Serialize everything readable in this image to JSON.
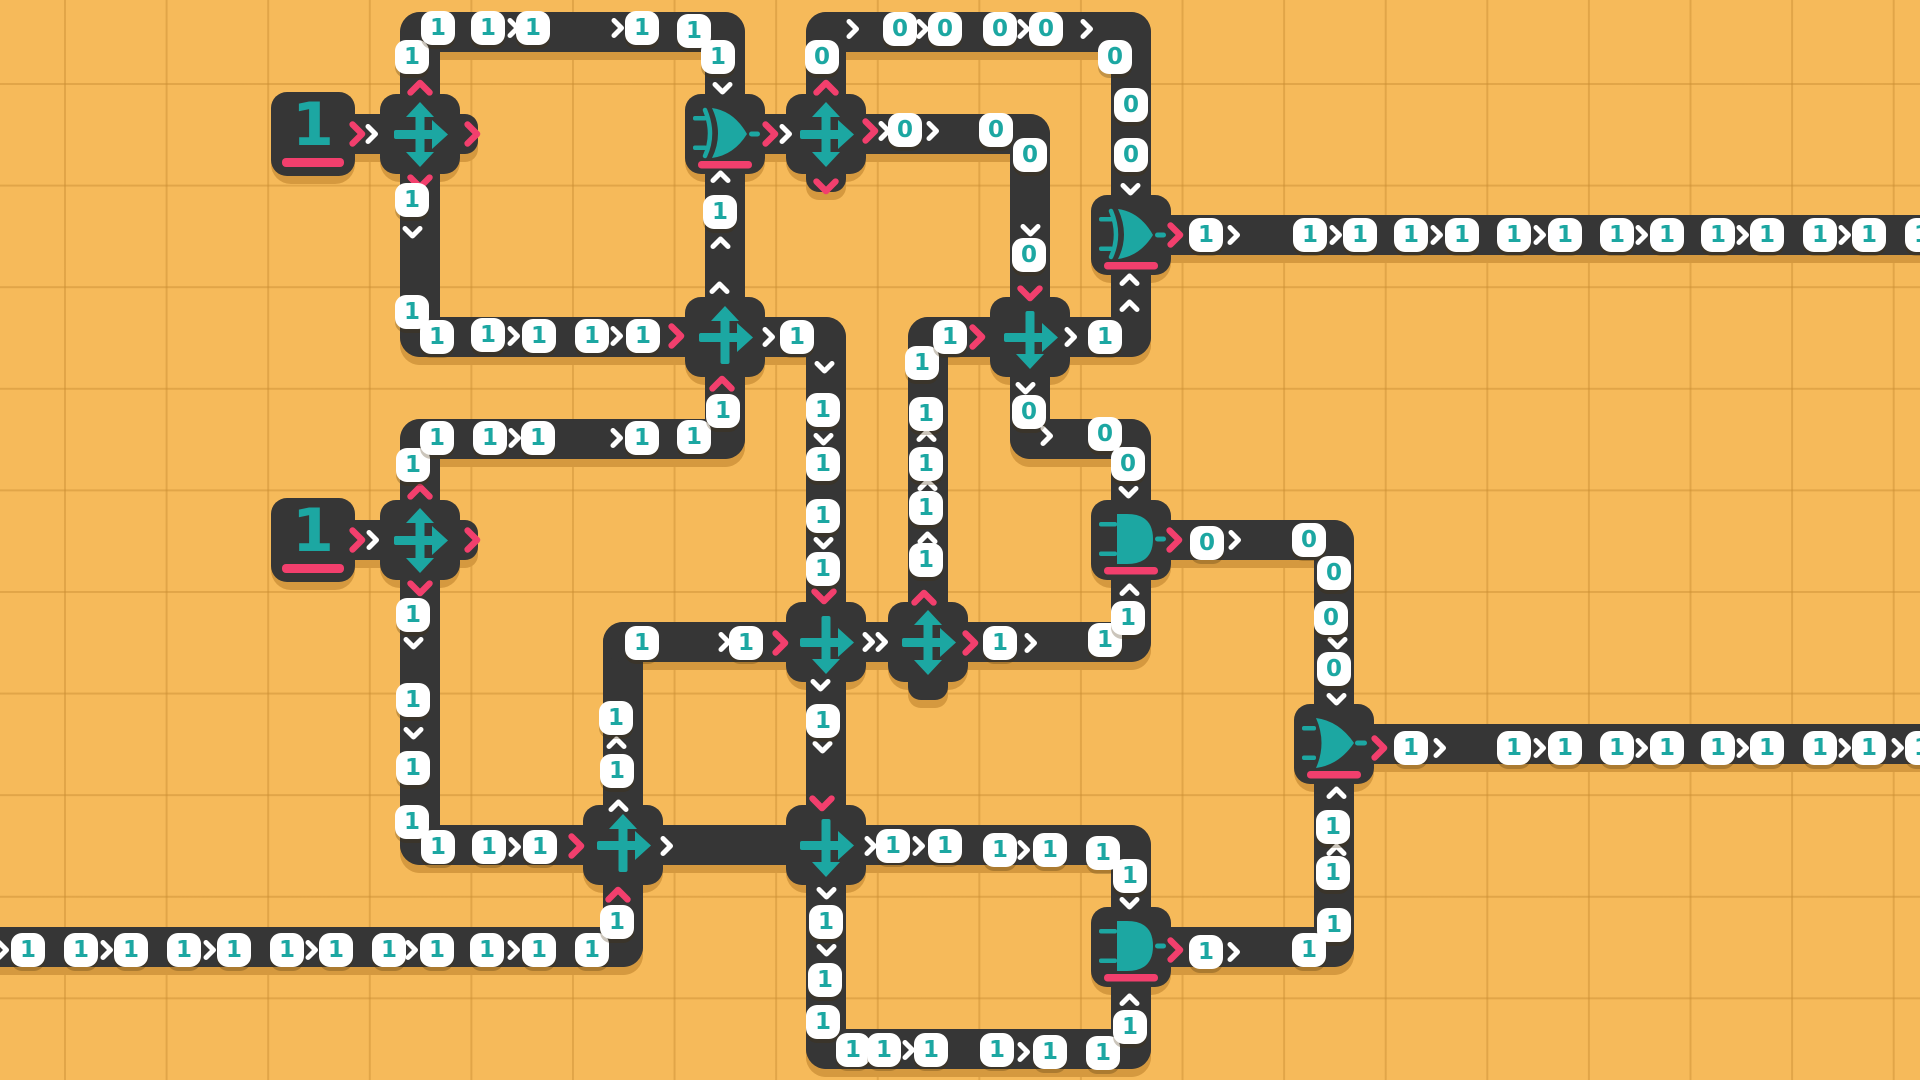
{
  "board": {
    "width": 1920,
    "height": 1080,
    "grid_pitch": 101.6,
    "grid_offset_x": 64,
    "grid_offset_y": 83
  },
  "colors": {
    "background": "#F6BA5A",
    "grid_line": "#DFA449",
    "wire": "#363636",
    "shadow": "#D5993F",
    "teal": "#1CA7A2",
    "pink": "#F23F6D",
    "pill": "#FFFFFF"
  },
  "legend": {
    "pill_values": [
      "0",
      "1"
    ],
    "tile_types": [
      "source",
      "splitter",
      "cross_ur",
      "cross_dr",
      "xor",
      "and",
      "or"
    ]
  },
  "tiles": [
    {
      "type": "source",
      "x": 313,
      "y": 134,
      "label": "1"
    },
    {
      "type": "splitter",
      "x": 420,
      "y": 134
    },
    {
      "type": "xor",
      "x": 725,
      "y": 134
    },
    {
      "type": "splitter",
      "x": 826,
      "y": 134
    },
    {
      "type": "xor",
      "x": 1131,
      "y": 235
    },
    {
      "type": "cross_ur",
      "x": 725,
      "y": 337
    },
    {
      "type": "cross_dr",
      "x": 1030,
      "y": 337
    },
    {
      "type": "source",
      "x": 313,
      "y": 540,
      "label": "1"
    },
    {
      "type": "splitter",
      "x": 420,
      "y": 540
    },
    {
      "type": "and",
      "x": 1131,
      "y": 540
    },
    {
      "type": "cross_dr",
      "x": 826,
      "y": 642
    },
    {
      "type": "splitter",
      "x": 928,
      "y": 642
    },
    {
      "type": "or",
      "x": 1334,
      "y": 744
    },
    {
      "type": "cross_ur",
      "x": 623,
      "y": 845
    },
    {
      "type": "cross_dr",
      "x": 826,
      "y": 845
    },
    {
      "type": "and",
      "x": 1131,
      "y": 947
    }
  ],
  "nubs": [
    {
      "x": 420,
      "y": 134,
      "dir": "r"
    },
    {
      "x": 826,
      "y": 134,
      "dir": "d"
    },
    {
      "x": 420,
      "y": 540,
      "dir": "r"
    },
    {
      "x": 928,
      "y": 642,
      "dir": "d"
    }
  ],
  "wires": [
    [
      330,
      134,
      392,
      134
    ],
    [
      420,
      134,
      420,
      32
    ],
    [
      420,
      32,
      725,
      32
    ],
    [
      725,
      32,
      725,
      134
    ],
    [
      420,
      134,
      420,
      337
    ],
    [
      420,
      337,
      725,
      337
    ],
    [
      725,
      337,
      725,
      134
    ],
    [
      758,
      134,
      795,
      134
    ],
    [
      826,
      134,
      826,
      32
    ],
    [
      826,
      32,
      1131,
      32
    ],
    [
      1131,
      32,
      1131,
      235
    ],
    [
      862,
      134,
      1030,
      134
    ],
    [
      1030,
      134,
      1030,
      337
    ],
    [
      1030,
      337,
      1030,
      439
    ],
    [
      1030,
      439,
      1131,
      439
    ],
    [
      1131,
      439,
      1131,
      540
    ],
    [
      1066,
      337,
      1131,
      337
    ],
    [
      1131,
      337,
      1131,
      235
    ],
    [
      1167,
      235,
      1940,
      235
    ],
    [
      761,
      337,
      826,
      337
    ],
    [
      826,
      337,
      826,
      642
    ],
    [
      928,
      642,
      928,
      337
    ],
    [
      928,
      337,
      994,
      337
    ],
    [
      330,
      540,
      392,
      540
    ],
    [
      420,
      540,
      420,
      439
    ],
    [
      420,
      439,
      725,
      439
    ],
    [
      725,
      439,
      725,
      337
    ],
    [
      420,
      540,
      420,
      845
    ],
    [
      420,
      845,
      623,
      845
    ],
    [
      623,
      845,
      623,
      642
    ],
    [
      623,
      642,
      826,
      642
    ],
    [
      862,
      642,
      928,
      642
    ],
    [
      964,
      642,
      1131,
      642
    ],
    [
      1131,
      642,
      1131,
      540
    ],
    [
      1167,
      540,
      1334,
      540
    ],
    [
      1334,
      540,
      1334,
      744
    ],
    [
      1334,
      744,
      1334,
      947
    ],
    [
      1334,
      947,
      1167,
      947
    ],
    [
      1370,
      744,
      1940,
      744
    ],
    [
      826,
      642,
      826,
      845
    ],
    [
      659,
      845,
      826,
      845
    ],
    [
      862,
      845,
      1131,
      845
    ],
    [
      1131,
      845,
      1131,
      947
    ],
    [
      826,
      845,
      826,
      1049
    ],
    [
      826,
      1049,
      1131,
      1049
    ],
    [
      1131,
      1049,
      1131,
      947
    ],
    [
      -30,
      947,
      623,
      947
    ],
    [
      623,
      947,
      623,
      845
    ]
  ],
  "pills": [
    [
      412,
      57,
      "1"
    ],
    [
      438,
      28,
      "1"
    ],
    [
      488,
      28,
      "1"
    ],
    [
      533,
      28,
      "1"
    ],
    [
      642,
      28,
      "1"
    ],
    [
      694,
      31,
      "1"
    ],
    [
      718,
      57,
      "1"
    ],
    [
      720,
      212,
      "1"
    ],
    [
      412,
      200,
      "1"
    ],
    [
      412,
      312,
      "1"
    ],
    [
      437,
      337,
      "1"
    ],
    [
      488,
      335,
      "1"
    ],
    [
      539,
      336,
      "1"
    ],
    [
      592,
      336,
      "1"
    ],
    [
      643,
      336,
      "1"
    ],
    [
      822,
      57,
      "0"
    ],
    [
      900,
      29,
      "0"
    ],
    [
      945,
      29,
      "0"
    ],
    [
      1000,
      29,
      "0"
    ],
    [
      1046,
      29,
      "0"
    ],
    [
      1115,
      57,
      "0"
    ],
    [
      1131,
      105,
      "0"
    ],
    [
      1131,
      155,
      "0"
    ],
    [
      905,
      130,
      "0"
    ],
    [
      996,
      130,
      "0"
    ],
    [
      1030,
      155,
      "0"
    ],
    [
      1029,
      255,
      "0"
    ],
    [
      1029,
      412,
      "0"
    ],
    [
      1105,
      434,
      "0"
    ],
    [
      1128,
      464,
      "0"
    ],
    [
      1105,
      337,
      "1"
    ],
    [
      1206,
      235,
      "1"
    ],
    [
      1310,
      235,
      "1"
    ],
    [
      1360,
      235,
      "1"
    ],
    [
      1411,
      235,
      "1"
    ],
    [
      1462,
      235,
      "1"
    ],
    [
      1514,
      235,
      "1"
    ],
    [
      1565,
      235,
      "1"
    ],
    [
      1617,
      235,
      "1"
    ],
    [
      1667,
      235,
      "1"
    ],
    [
      1718,
      235,
      "1"
    ],
    [
      1767,
      235,
      "1"
    ],
    [
      1820,
      235,
      "1"
    ],
    [
      1869,
      235,
      "1"
    ],
    [
      1922,
      235,
      "1"
    ],
    [
      413,
      465,
      "1"
    ],
    [
      437,
      438,
      "1"
    ],
    [
      490,
      438,
      "1"
    ],
    [
      538,
      438,
      "1"
    ],
    [
      642,
      438,
      "1"
    ],
    [
      694,
      437,
      "1"
    ],
    [
      723,
      411,
      "1"
    ],
    [
      797,
      337,
      "1"
    ],
    [
      823,
      410,
      "1"
    ],
    [
      823,
      464,
      "1"
    ],
    [
      823,
      516,
      "1"
    ],
    [
      823,
      569,
      "1"
    ],
    [
      926,
      560,
      "1"
    ],
    [
      926,
      508,
      "1"
    ],
    [
      926,
      464,
      "1"
    ],
    [
      926,
      414,
      "1"
    ],
    [
      922,
      363,
      "1"
    ],
    [
      950,
      337,
      "1"
    ],
    [
      413,
      615,
      "1"
    ],
    [
      413,
      700,
      "1"
    ],
    [
      413,
      768,
      "1"
    ],
    [
      412,
      822,
      "1"
    ],
    [
      438,
      847,
      "1"
    ],
    [
      489,
      847,
      "1"
    ],
    [
      540,
      847,
      "1"
    ],
    [
      617,
      771,
      "1"
    ],
    [
      616,
      718,
      "1"
    ],
    [
      642,
      643,
      "1"
    ],
    [
      746,
      643,
      "1"
    ],
    [
      823,
      721,
      "1"
    ],
    [
      1000,
      643,
      "1"
    ],
    [
      1105,
      640,
      "1"
    ],
    [
      1128,
      618,
      "1"
    ],
    [
      1207,
      543,
      "0"
    ],
    [
      1309,
      540,
      "0"
    ],
    [
      1334,
      573,
      "0"
    ],
    [
      1331,
      618,
      "0"
    ],
    [
      1334,
      669,
      "0"
    ],
    [
      1333,
      827,
      "1"
    ],
    [
      1333,
      873,
      "1"
    ],
    [
      1334,
      925,
      "1"
    ],
    [
      1309,
      950,
      "1"
    ],
    [
      1411,
      748,
      "1"
    ],
    [
      1514,
      748,
      "1"
    ],
    [
      1565,
      748,
      "1"
    ],
    [
      1617,
      748,
      "1"
    ],
    [
      1667,
      748,
      "1"
    ],
    [
      1718,
      748,
      "1"
    ],
    [
      1767,
      748,
      "1"
    ],
    [
      1820,
      748,
      "1"
    ],
    [
      1869,
      748,
      "1"
    ],
    [
      1922,
      748,
      "1"
    ],
    [
      1206,
      952,
      "1"
    ],
    [
      893,
      846,
      "1"
    ],
    [
      945,
      846,
      "1"
    ],
    [
      1000,
      850,
      "1"
    ],
    [
      1050,
      850,
      "1"
    ],
    [
      1103,
      853,
      "1"
    ],
    [
      1130,
      876,
      "1"
    ],
    [
      826,
      922,
      "1"
    ],
    [
      825,
      980,
      "1"
    ],
    [
      823,
      1022,
      "1"
    ],
    [
      853,
      1050,
      "1"
    ],
    [
      884,
      1050,
      "1"
    ],
    [
      931,
      1050,
      "1"
    ],
    [
      997,
      1050,
      "1"
    ],
    [
      1050,
      1052,
      "1"
    ],
    [
      1103,
      1053,
      "1"
    ],
    [
      1130,
      1027,
      "1"
    ],
    [
      28,
      950,
      "1"
    ],
    [
      81,
      950,
      "1"
    ],
    [
      131,
      950,
      "1"
    ],
    [
      184,
      950,
      "1"
    ],
    [
      234,
      950,
      "1"
    ],
    [
      287,
      950,
      "1"
    ],
    [
      336,
      950,
      "1"
    ],
    [
      389,
      950,
      "1"
    ],
    [
      437,
      950,
      "1"
    ],
    [
      487,
      950,
      "1"
    ],
    [
      539,
      950,
      "1"
    ],
    [
      592,
      950,
      "1"
    ],
    [
      617,
      922,
      "1"
    ]
  ],
  "chevrons": [
    [
      513,
      28,
      "r",
      "w"
    ],
    [
      617,
      28,
      "r",
      "w"
    ],
    [
      722,
      88,
      "d",
      "w"
    ],
    [
      720,
      177,
      "u",
      "w"
    ],
    [
      720,
      243,
      "u",
      "w"
    ],
    [
      719,
      288,
      "u",
      "w"
    ],
    [
      412,
      232,
      "d",
      "w"
    ],
    [
      513,
      336,
      "r",
      "w"
    ],
    [
      616,
      336,
      "r",
      "w"
    ],
    [
      676,
      336,
      "r",
      "p"
    ],
    [
      420,
      88,
      "u",
      "p"
    ],
    [
      420,
      182,
      "d",
      "p"
    ],
    [
      472,
      134,
      "r",
      "p"
    ],
    [
      357,
      134,
      "r",
      "p"
    ],
    [
      371,
      134,
      "r",
      "w"
    ],
    [
      826,
      88,
      "u",
      "p"
    ],
    [
      826,
      186,
      "d",
      "p"
    ],
    [
      870,
      131,
      "r",
      "p"
    ],
    [
      770,
      134,
      "r",
      "p"
    ],
    [
      785,
      134,
      "r",
      "w"
    ],
    [
      852,
      29,
      "r",
      "w"
    ],
    [
      922,
      29,
      "r",
      "w"
    ],
    [
      1023,
      29,
      "r",
      "w"
    ],
    [
      1086,
      29,
      "r",
      "w"
    ],
    [
      884,
      131,
      "r",
      "w"
    ],
    [
      932,
      131,
      "r",
      "w"
    ],
    [
      1030,
      230,
      "d",
      "w"
    ],
    [
      1130,
      189,
      "d",
      "w"
    ],
    [
      1030,
      293,
      "d",
      "p"
    ],
    [
      977,
      337,
      "r",
      "p"
    ],
    [
      1025,
      388,
      "d",
      "w"
    ],
    [
      1046,
      436,
      "r",
      "w"
    ],
    [
      1128,
      492,
      "d",
      "w"
    ],
    [
      1070,
      337,
      "r",
      "w"
    ],
    [
      1129,
      306,
      "u",
      "w"
    ],
    [
      1129,
      280,
      "u",
      "w"
    ],
    [
      1175,
      235,
      "r",
      "p"
    ],
    [
      1233,
      235,
      "r",
      "w"
    ],
    [
      1335,
      235,
      "r",
      "w"
    ],
    [
      1436,
      235,
      "r",
      "w"
    ],
    [
      1539,
      235,
      "r",
      "w"
    ],
    [
      1641,
      235,
      "r",
      "w"
    ],
    [
      1742,
      235,
      "r",
      "w"
    ],
    [
      1844,
      235,
      "r",
      "w"
    ],
    [
      722,
      384,
      "u",
      "p"
    ],
    [
      420,
      492,
      "u",
      "p"
    ],
    [
      357,
      540,
      "r",
      "p"
    ],
    [
      420,
      588,
      "d",
      "p"
    ],
    [
      472,
      540,
      "r",
      "p"
    ],
    [
      372,
      540,
      "r",
      "w"
    ],
    [
      514,
      438,
      "r",
      "w"
    ],
    [
      616,
      438,
      "r",
      "w"
    ],
    [
      768,
      337,
      "r",
      "w"
    ],
    [
      824,
      367,
      "d",
      "w"
    ],
    [
      823,
      439,
      "d",
      "w"
    ],
    [
      823,
      543,
      "d",
      "w"
    ],
    [
      824,
      596,
      "d",
      "p"
    ],
    [
      927,
      538,
      "u",
      "w"
    ],
    [
      927,
      485,
      "u",
      "w"
    ],
    [
      926,
      436,
      "u",
      "w"
    ],
    [
      924,
      598,
      "u",
      "p"
    ],
    [
      413,
      643,
      "d",
      "w"
    ],
    [
      413,
      733,
      "d",
      "w"
    ],
    [
      514,
      847,
      "r",
      "w"
    ],
    [
      576,
      846,
      "r",
      "p"
    ],
    [
      618,
      895,
      "u",
      "p"
    ],
    [
      618,
      806,
      "u",
      "w"
    ],
    [
      666,
      846,
      "r",
      "w"
    ],
    [
      616,
      743,
      "u",
      "w"
    ],
    [
      724,
      642,
      "r",
      "w"
    ],
    [
      780,
      643,
      "r",
      "p"
    ],
    [
      820,
      685,
      "d",
      "w"
    ],
    [
      822,
      747,
      "d",
      "w"
    ],
    [
      822,
      803,
      "d",
      "p"
    ],
    [
      868,
      642,
      "r",
      "w"
    ],
    [
      881,
      642,
      "r",
      "w"
    ],
    [
      970,
      643,
      "r",
      "p"
    ],
    [
      1030,
      643,
      "r",
      "w"
    ],
    [
      1129,
      590,
      "u",
      "w"
    ],
    [
      1174,
      540,
      "r",
      "p"
    ],
    [
      1234,
      540,
      "r",
      "w"
    ],
    [
      1337,
      643,
      "d",
      "w"
    ],
    [
      1336,
      699,
      "d",
      "w"
    ],
    [
      1336,
      793,
      "u",
      "w"
    ],
    [
      1336,
      850,
      "u",
      "w"
    ],
    [
      1379,
      748,
      "r",
      "p"
    ],
    [
      1439,
      748,
      "r",
      "w"
    ],
    [
      1539,
      748,
      "r",
      "w"
    ],
    [
      1641,
      748,
      "r",
      "w"
    ],
    [
      1742,
      748,
      "r",
      "w"
    ],
    [
      1844,
      748,
      "r",
      "w"
    ],
    [
      1897,
      748,
      "r",
      "w"
    ],
    [
      1175,
      950,
      "r",
      "p"
    ],
    [
      1233,
      952,
      "r",
      "w"
    ],
    [
      870,
      846,
      "r",
      "w"
    ],
    [
      918,
      846,
      "r",
      "w"
    ],
    [
      1023,
      850,
      "r",
      "w"
    ],
    [
      1129,
      903,
      "d",
      "w"
    ],
    [
      826,
      893,
      "d",
      "w"
    ],
    [
      826,
      950,
      "d",
      "w"
    ],
    [
      908,
      1050,
      "r",
      "w"
    ],
    [
      1023,
      1052,
      "r",
      "w"
    ],
    [
      1129,
      1000,
      "u",
      "w"
    ],
    [
      2,
      950,
      "r",
      "w"
    ],
    [
      106,
      950,
      "r",
      "w"
    ],
    [
      209,
      950,
      "r",
      "w"
    ],
    [
      311,
      950,
      "r",
      "w"
    ],
    [
      411,
      950,
      "r",
      "w"
    ],
    [
      513,
      950,
      "r",
      "w"
    ]
  ]
}
